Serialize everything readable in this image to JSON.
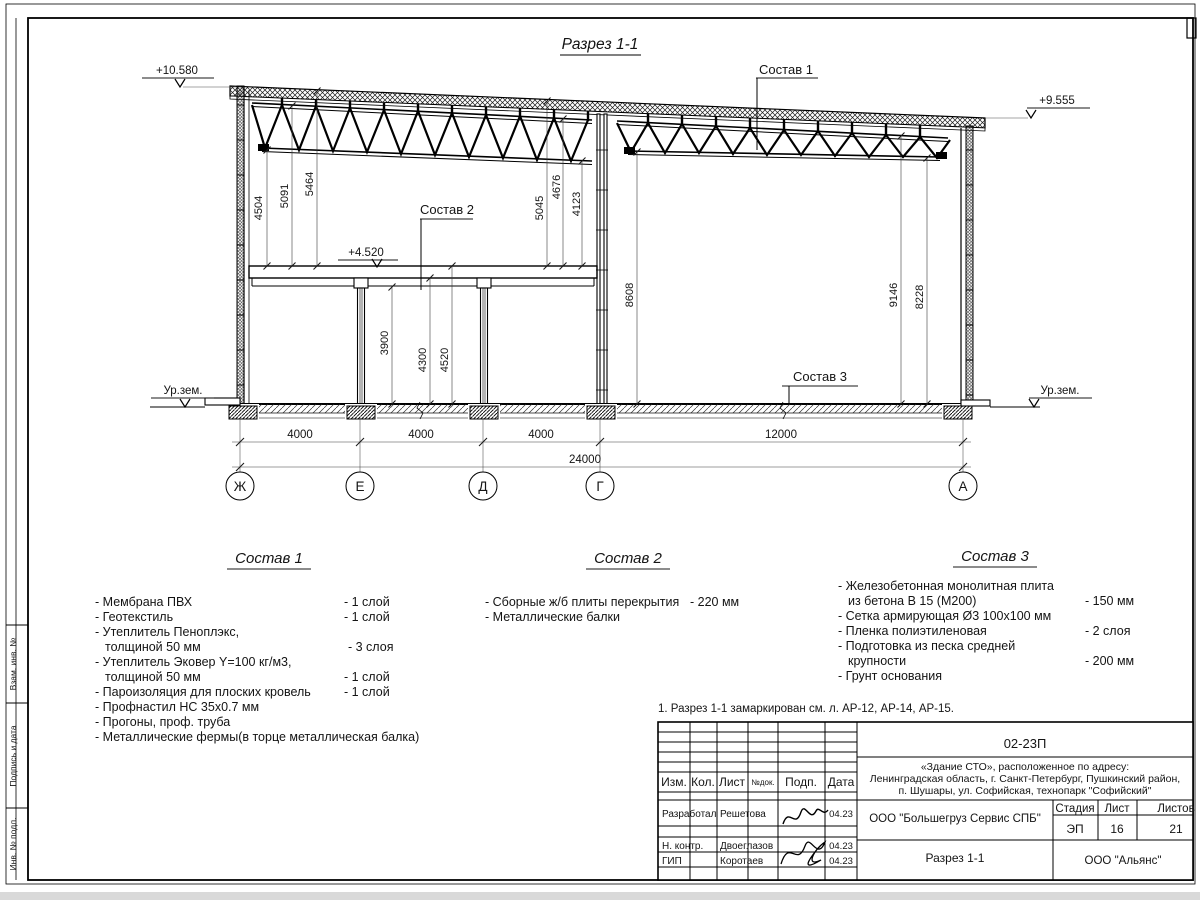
{
  "drawing": {
    "title": "Разрез 1-1",
    "elev": {
      "e10580": "+10.580",
      "e9555": "+9.555",
      "e4520": "+4.520",
      "ground": "Ур.зем."
    },
    "callouts": {
      "c1": "Состав 1",
      "c2": "Состав 2",
      "c3": "Состав 3"
    },
    "dims": {
      "d4504": "4504",
      "d5091": "5091",
      "d5464": "5464",
      "d5045": "5045",
      "d4676": "4676",
      "d4123": "4123",
      "d8608": "8608",
      "d9146": "9146",
      "d8228": "8228",
      "d3900": "3900",
      "d4300": "4300",
      "d4520": "4520",
      "span1": "4000",
      "span2": "4000",
      "span3": "4000",
      "span4": "12000",
      "total": "24000"
    },
    "axes": {
      "a1": "Ж",
      "a2": "Е",
      "a3": "Д",
      "a4": "Г",
      "a5": "А"
    }
  },
  "compositions": {
    "c1": {
      "heading": "Состав 1",
      "items": [
        {
          "name": "- Мембрана ПВХ",
          "qty": "- 1 слой"
        },
        {
          "name": "- Геотекстиль",
          "qty": "- 1 слой"
        },
        {
          "name": "- Утеплитель Пеноплэкс,",
          "qty": ""
        },
        {
          "name": "толщиной 50 мм",
          "qty": "- 3 слоя"
        },
        {
          "name": "- Утеплитель Эковер Y=100 кг/м3,",
          "qty": ""
        },
        {
          "name": "толщиной 50 мм",
          "qty": "- 1 слой"
        },
        {
          "name": "- Пароизоляция для плоских кровель",
          "qty": "- 1 слой"
        },
        {
          "name": "- Профнастил НС 35х0.7 мм",
          "qty": ""
        },
        {
          "name": "- Прогоны, проф. труба",
          "qty": ""
        },
        {
          "name": "- Металлические фермы(в торце металлическая балка)",
          "qty": ""
        }
      ]
    },
    "c2": {
      "heading": "Состав 2",
      "items": [
        {
          "name": "- Сборные ж/б плиты перекрытия",
          "qty": "- 220 мм"
        },
        {
          "name": "- Металлические балки",
          "qty": ""
        }
      ]
    },
    "c3": {
      "heading": "Состав 3",
      "items": [
        {
          "name": "- Железобетонная  монолитная плита",
          "qty": ""
        },
        {
          "name": "из бетона В 15 (М200)",
          "qty": "- 150 мм"
        },
        {
          "name": "- Сетка армирующая Ø3 100х100 мм",
          "qty": ""
        },
        {
          "name": "- Пленка полиэтиленовая",
          "qty": "-  2 слоя"
        },
        {
          "name": "- Подготовка из песка средней",
          "qty": ""
        },
        {
          "name": "крупности",
          "qty": "- 200 мм"
        },
        {
          "name": "- Грунт основания",
          "qty": ""
        }
      ]
    }
  },
  "note": "1. Разрез 1-1 замаркирован см. л. АР-12, АР-14, АР-15.",
  "titleblock": {
    "code": "02-23П",
    "object1": "«Здание СТО», расположенное по адресу:",
    "object2": "Ленинградская область, г. Санкт-Петербург, Пушкинский район,",
    "object3": "п. Шушары, ул. Софийская, технопарк \"Софийский\"",
    "col_izm": "Изм.",
    "col_kol": "Кол.",
    "col_list": "Лист",
    "col_ndok": "№док.",
    "col_podp": "Подп.",
    "col_data": "Дата",
    "r1_role": "Разработал",
    "r1_name": "Решетова",
    "r1_date": "04.23",
    "r2_role": "Н. контр.",
    "r2_name": "Двоеглазов",
    "r2_date": "04.23",
    "r3_role": "ГИП",
    "r3_name": "Коротаев",
    "r3_date": "04.23",
    "org": "ООО \"Большегруз Сервис СПБ\"",
    "stage_label": "Стадия",
    "sheet_label": "Лист",
    "sheets_label": "Листов",
    "stage": "ЭП",
    "sheet": "16",
    "sheets": "21",
    "doc_name": "Разрез 1-1",
    "org2": "ООО \"Альянс\""
  },
  "frame": {
    "s1": "Взам. инв. №",
    "s2": "Подпись и дата",
    "s3": "Инв. № подл."
  }
}
